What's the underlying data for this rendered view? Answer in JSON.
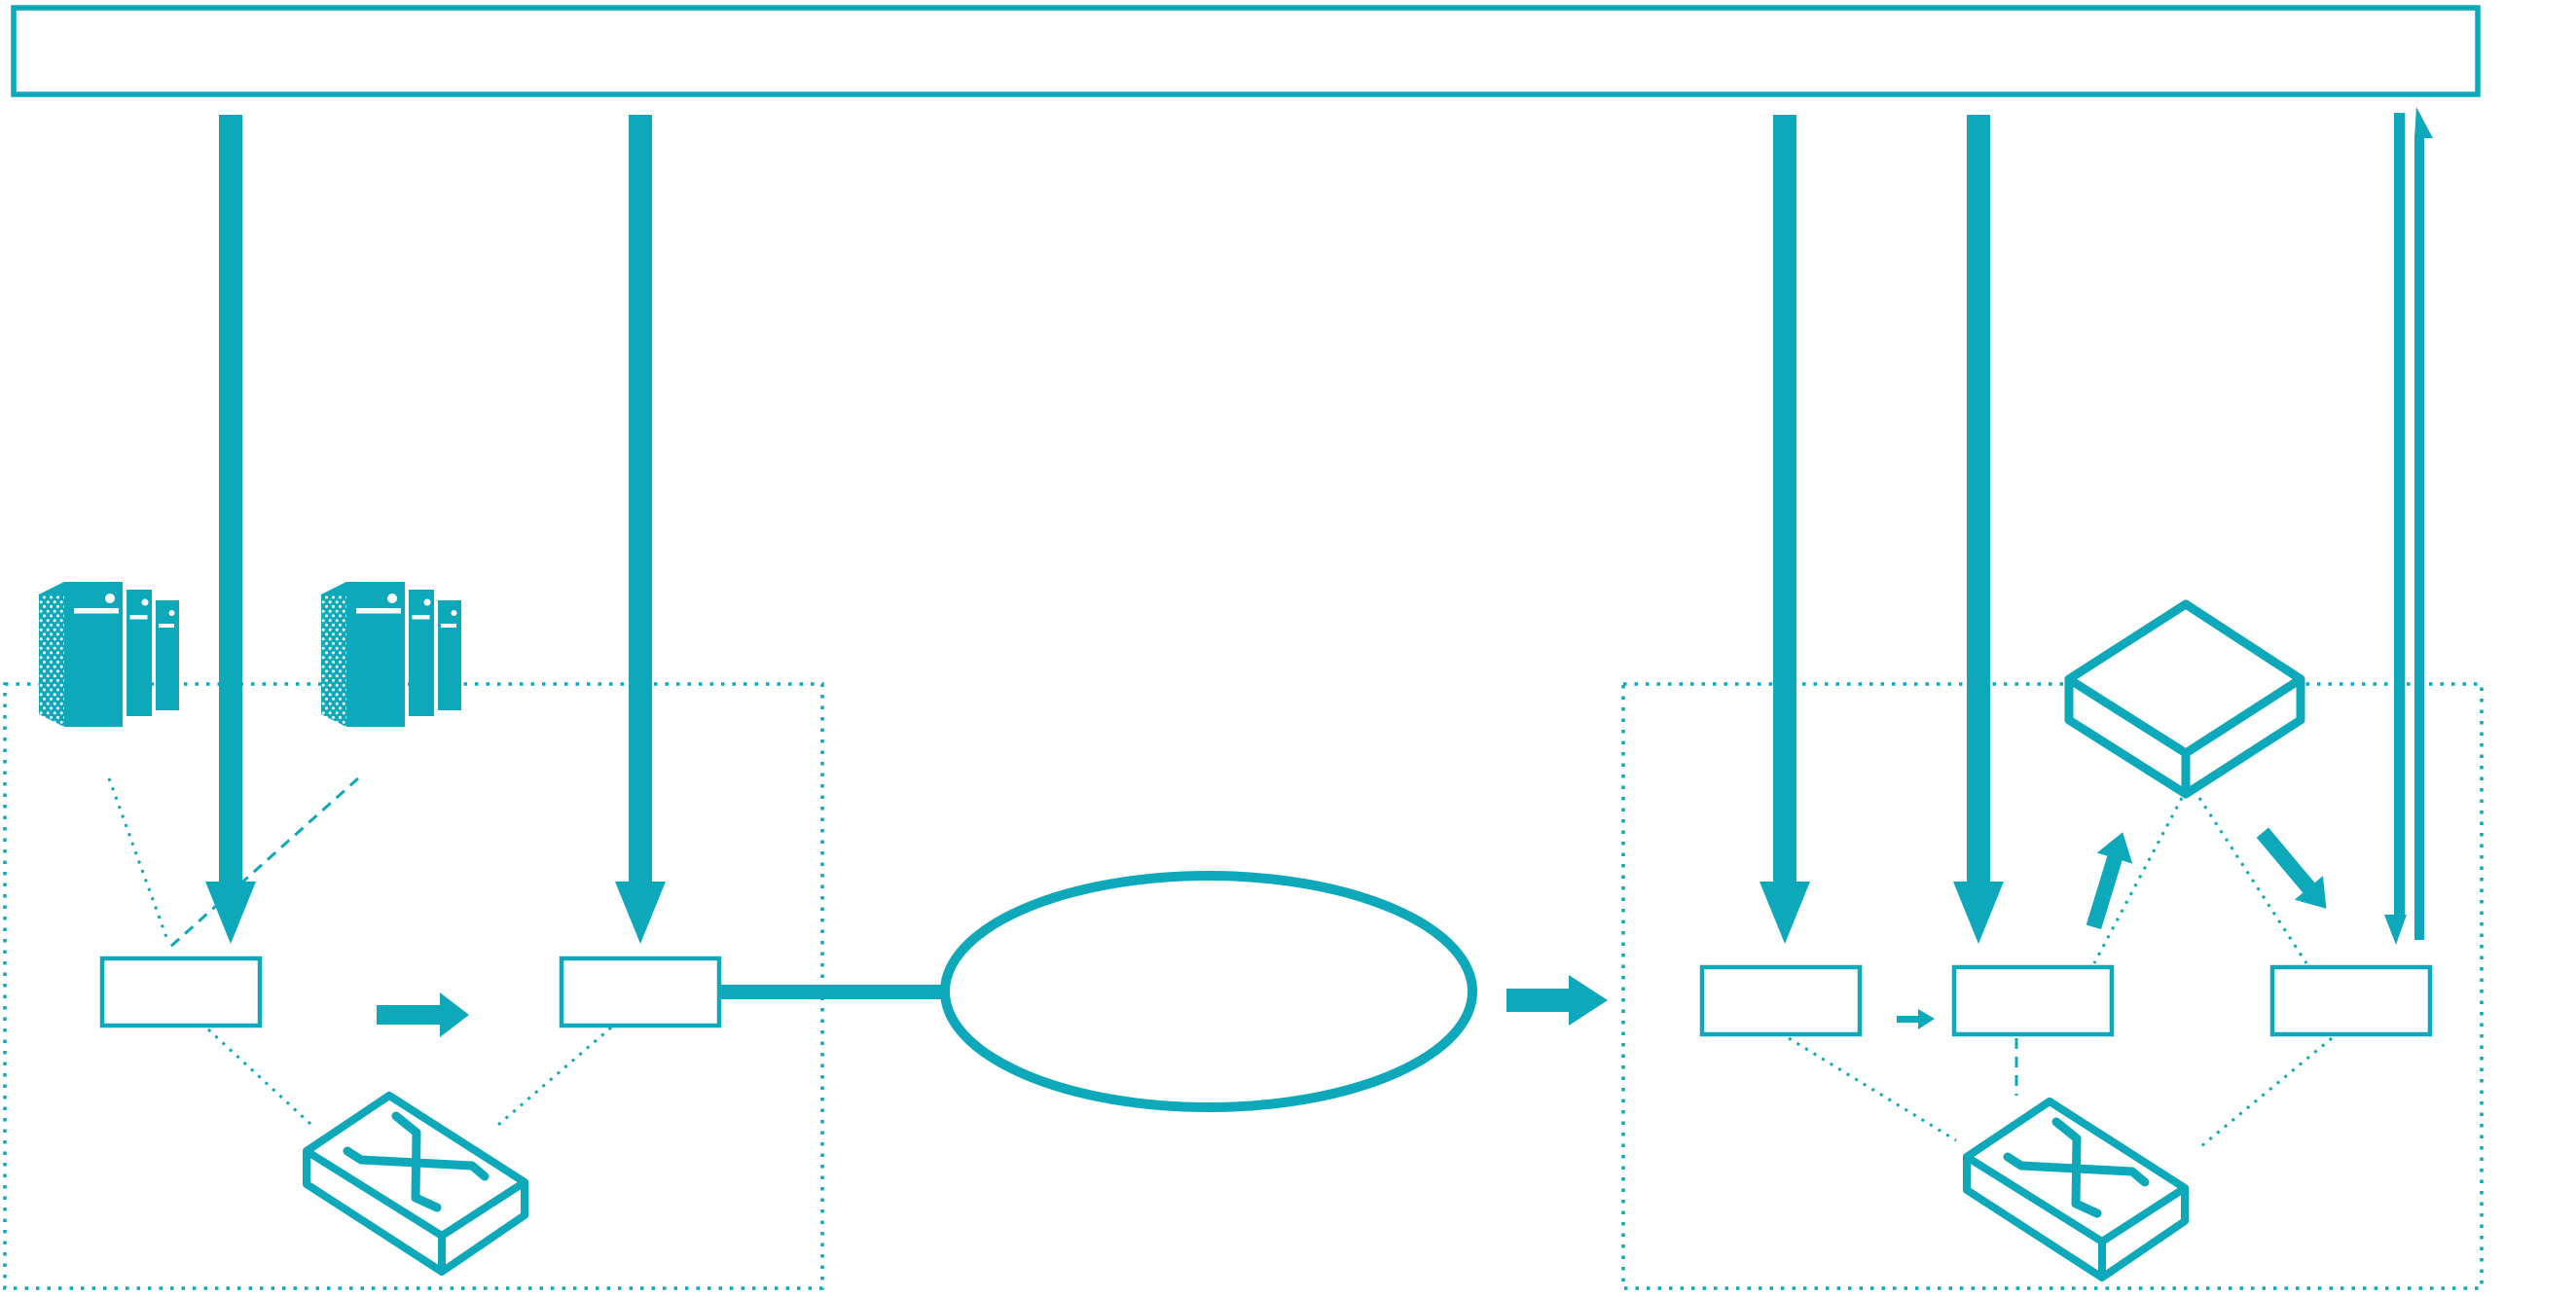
{
  "theme": {
    "accent_color": "#0da9ba",
    "background_color": "#ffffff"
  },
  "banner": {
    "label": ""
  },
  "left_zone": {
    "border_style": "dotted",
    "server_cluster_count": 2,
    "icons": [
      "server-cluster-icon",
      "server-cluster-icon",
      "crossbar-switch-icon"
    ],
    "boxes": [
      {
        "label": ""
      },
      {
        "label": ""
      }
    ]
  },
  "middle": {
    "ellipse_label": "",
    "link_count": 1
  },
  "right_zone": {
    "border_style": "dotted",
    "icons": [
      "flat-box-icon",
      "crossbar-switch-icon"
    ],
    "boxes": [
      {
        "label": ""
      },
      {
        "label": ""
      },
      {
        "label": ""
      }
    ]
  },
  "arrows": {
    "down_flow_count": 4,
    "return_pair_count": 1,
    "diagonal_count": 2
  }
}
